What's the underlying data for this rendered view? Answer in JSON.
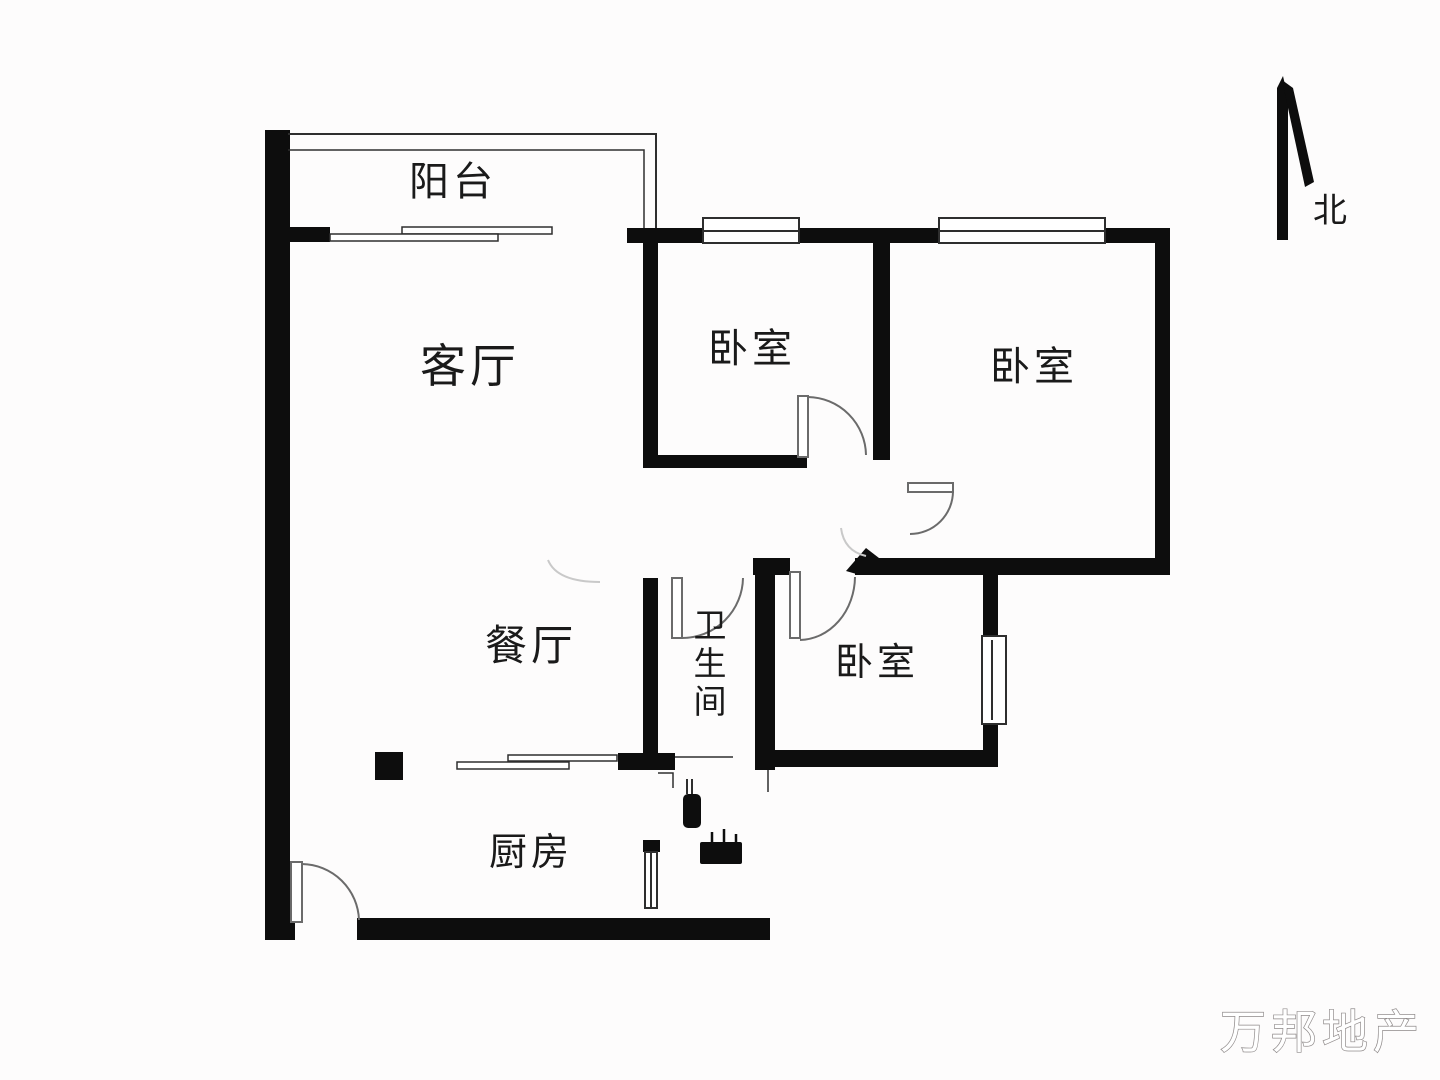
{
  "plan_title": "三室两厅户型图",
  "rooms": {
    "balcony": "阳台",
    "living_room": "客厅",
    "bedroom_top_middle": "卧室",
    "bedroom_top_right": "卧室",
    "bedroom_bottom_right": "卧室",
    "dining_room": "餐厅",
    "bathroom": "卫生间",
    "kitchen": "厨房"
  },
  "compass": {
    "north_label": "北"
  },
  "watermark": "万邦地产",
  "colors": {
    "wall": "#0d0d0d",
    "thin_line": "#2e2e2e",
    "door_arc": "#6b6b6b",
    "faint": "#c9c9c9",
    "text": "#1a1a1a",
    "watermark_stroke": "#8f8a8a",
    "background": "#fdfcfc"
  }
}
